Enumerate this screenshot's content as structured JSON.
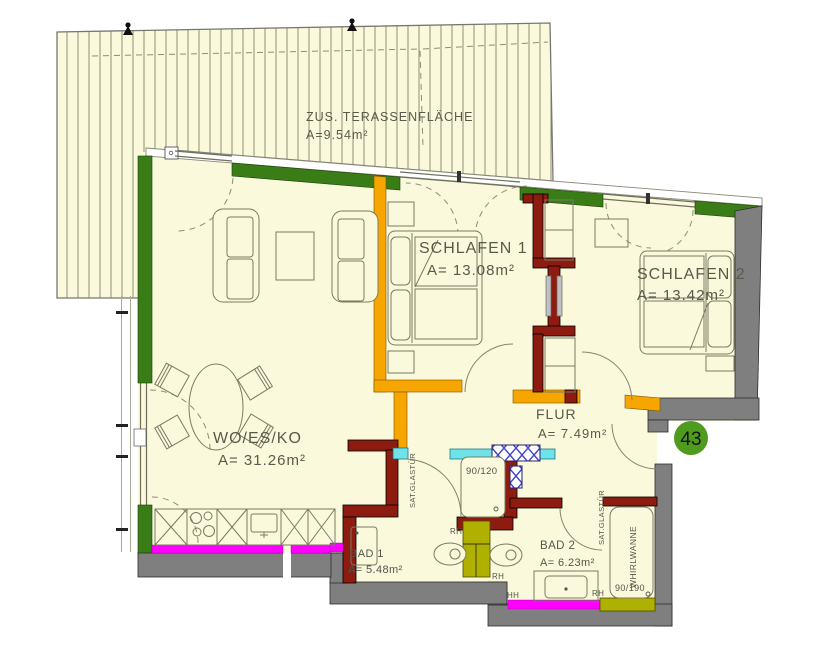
{
  "plan": {
    "unit_number": "43",
    "rooms": {
      "terrace": {
        "name": "ZUS. TERASSENFLÄCHE",
        "area": "A=9.54m²"
      },
      "living": {
        "name": "WO/ES/KO",
        "area": "A= 31.26m²"
      },
      "bedroom1": {
        "name": "SCHLAFEN 1",
        "area": "A= 13.08m²"
      },
      "bedroom2": {
        "name": "SCHLAFEN 2",
        "area": "A= 13.42m²"
      },
      "hall": {
        "name": "FLUR",
        "area": "A= 7.49m²"
      },
      "bath1": {
        "name": "BAD 1",
        "area": "A= 5.48m²"
      },
      "bath2": {
        "name": "BAD 2",
        "area": "A= 6.23m²"
      }
    },
    "fixtures": {
      "shower_size": "90/120",
      "tub_size": "90/190",
      "tub_label": "WHIRLWANNE",
      "glass_door_1": "SAT.GLASTÜR",
      "glass_door_2": "SAT.GLASTÜR"
    },
    "marks": {
      "rh_1": "RH",
      "rh_2": "RH",
      "rh_3": "RH",
      "hh_1": "HH"
    },
    "colors": {
      "floor": "#FAF9DC",
      "wall_green": "#3a7d17",
      "wall_orange": "#F7A600",
      "wall_red": "#8e1b10",
      "wall_gray": "#7f7f7f",
      "heating_magenta": "#FF00FF",
      "sanitary_olive": "#b0b000",
      "glass_cyan": "#6ee4ea",
      "badge_green": "#4f9b1d"
    }
  }
}
